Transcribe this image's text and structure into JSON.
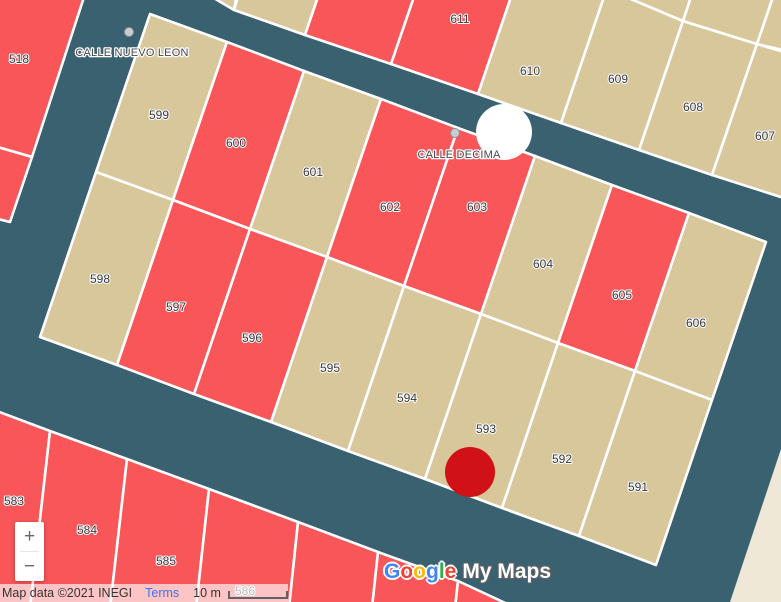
{
  "map": {
    "background_color": "#3a6170",
    "border_color": "#ffffff",
    "base_land_color": "#efe8d7",
    "parcel_colors": {
      "red": "#f95659",
      "tan": "#d9c79c"
    },
    "parcels": [
      {
        "id": "518",
        "number": "518",
        "color": "red"
      },
      {
        "id": "uL2",
        "number": "",
        "color": "red"
      },
      {
        "id": "uT1",
        "number": "",
        "color": "tan"
      },
      {
        "id": "uT2",
        "number": "",
        "color": "tan"
      },
      {
        "id": "uT3",
        "number": "",
        "color": "red"
      },
      {
        "id": "611",
        "number": "611",
        "color": "red"
      },
      {
        "id": "610",
        "number": "610",
        "color": "tan"
      },
      {
        "id": "609",
        "number": "609",
        "color": "tan"
      },
      {
        "id": "608",
        "number": "608",
        "color": "tan"
      },
      {
        "id": "607",
        "number": "607",
        "color": "tan"
      },
      {
        "id": "uS1",
        "number": "",
        "color": "tan"
      },
      {
        "id": "uS2",
        "number": "",
        "color": "tan"
      },
      {
        "id": "uS3",
        "number": "",
        "color": "tan"
      },
      {
        "id": "599",
        "number": "599",
        "color": "tan"
      },
      {
        "id": "600",
        "number": "600",
        "color": "red"
      },
      {
        "id": "601",
        "number": "601",
        "color": "tan"
      },
      {
        "id": "602",
        "number": "602",
        "color": "red"
      },
      {
        "id": "603",
        "number": "603",
        "color": "red"
      },
      {
        "id": "604",
        "number": "604",
        "color": "tan"
      },
      {
        "id": "605",
        "number": "605",
        "color": "red"
      },
      {
        "id": "606",
        "number": "606",
        "color": "tan"
      },
      {
        "id": "598",
        "number": "598",
        "color": "tan"
      },
      {
        "id": "597",
        "number": "597",
        "color": "red"
      },
      {
        "id": "596",
        "number": "596",
        "color": "red"
      },
      {
        "id": "595",
        "number": "595",
        "color": "tan"
      },
      {
        "id": "594",
        "number": "594",
        "color": "tan"
      },
      {
        "id": "593",
        "number": "593",
        "color": "tan"
      },
      {
        "id": "592",
        "number": "592",
        "color": "tan"
      },
      {
        "id": "591",
        "number": "591",
        "color": "tan"
      },
      {
        "id": "583",
        "number": "583",
        "color": "red"
      },
      {
        "id": "584",
        "number": "584",
        "color": "red"
      },
      {
        "id": "585",
        "number": "585",
        "color": "red"
      },
      {
        "id": "586",
        "number": "586",
        "color": "red"
      },
      {
        "id": "uB1",
        "number": "",
        "color": "red"
      },
      {
        "id": "uB2",
        "number": "",
        "color": "red"
      },
      {
        "id": "uB3",
        "number": "",
        "color": "red"
      }
    ],
    "streets": [
      {
        "id": "nuevoleon",
        "name": "CALLE NUEVO LEON",
        "label_x": 132,
        "label_y": 56,
        "dot_x": 129,
        "dot_y": 32
      },
      {
        "id": "decima",
        "name": "CALLE DECIMA",
        "label_x": 459,
        "label_y": 158,
        "dot_x": 455,
        "dot_y": 133
      }
    ],
    "street_dot_color": "#c9ccd1",
    "markers": [
      {
        "id": "white-circle-marker",
        "color": "#ffffff",
        "x": 504,
        "y": 132,
        "r": 28
      },
      {
        "id": "red-dot-marker",
        "color": "#d01118",
        "x": 470,
        "y": 472,
        "r": 25
      }
    ]
  },
  "controls": {
    "zoom_in": "+",
    "zoom_out": "−"
  },
  "watermark": {
    "google_letters": [
      {
        "ch": "G",
        "color": "#4285f4"
      },
      {
        "ch": "o",
        "color": "#ea4335"
      },
      {
        "ch": "o",
        "color": "#fbbc04"
      },
      {
        "ch": "g",
        "color": "#4285f4"
      },
      {
        "ch": "l",
        "color": "#34a853"
      },
      {
        "ch": "e",
        "color": "#ea4335"
      }
    ],
    "suffix": "My Maps"
  },
  "attribution": {
    "map_data": "Map data ©2021 INEGI",
    "terms": "Terms",
    "scale": "10 m"
  }
}
